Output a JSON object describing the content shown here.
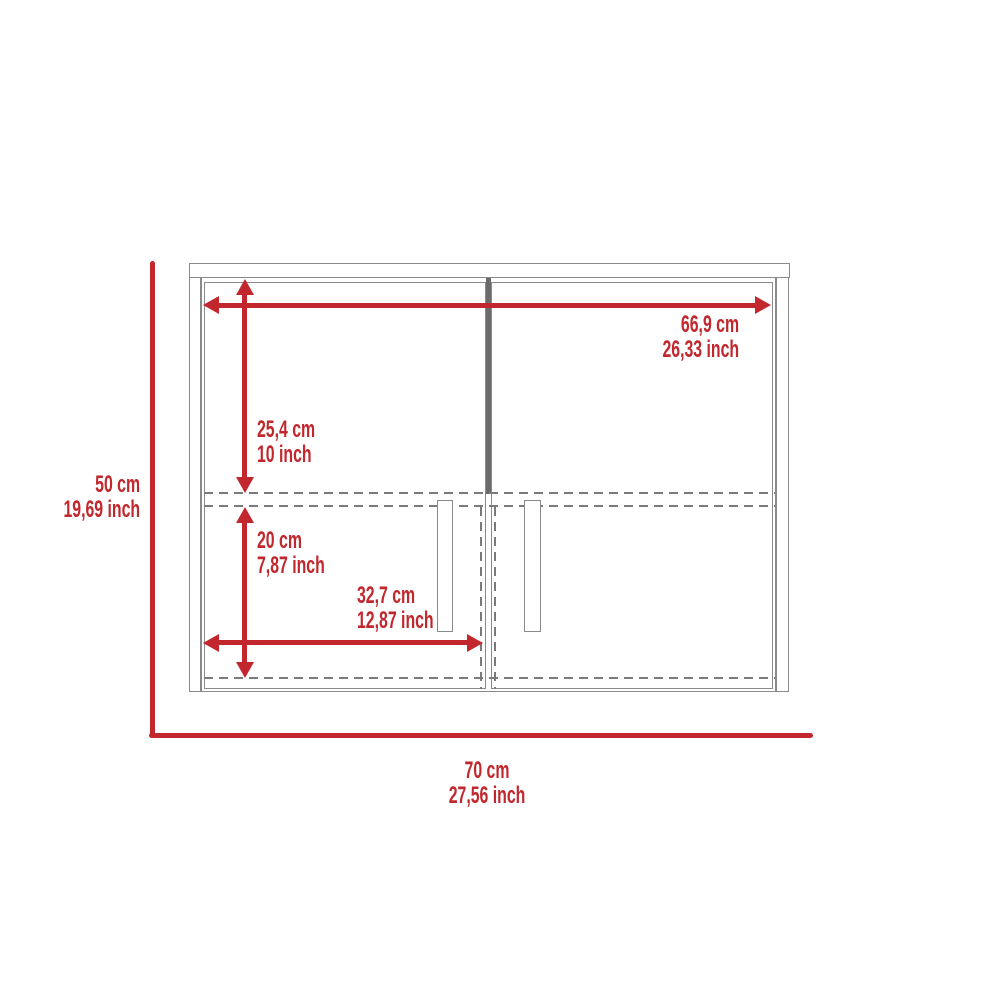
{
  "diagram": {
    "name": "wall-cabinet-dimension-drawing",
    "colors": {
      "dimension_red": "#c1272d",
      "outline_gray": "#8a8a8a",
      "divider_gray": "#6b6b6b",
      "dashed_gray": "#7a7a7a",
      "background": "#ffffff"
    },
    "labels": {
      "inner_width": {
        "cm": "66,9 cm",
        "inch": "26,33 inch"
      },
      "upper_height": {
        "cm": "25,4 cm",
        "inch": "10 inch"
      },
      "lower_height": {
        "cm": "20 cm",
        "inch": "7,87 inch"
      },
      "door_width": {
        "cm": "32,7 cm",
        "inch": "12,87 inch"
      },
      "overall_height": {
        "cm": "50 cm",
        "inch": "19,69 inch"
      },
      "overall_width": {
        "cm": "70 cm",
        "inch": "27,56 inch"
      }
    }
  }
}
